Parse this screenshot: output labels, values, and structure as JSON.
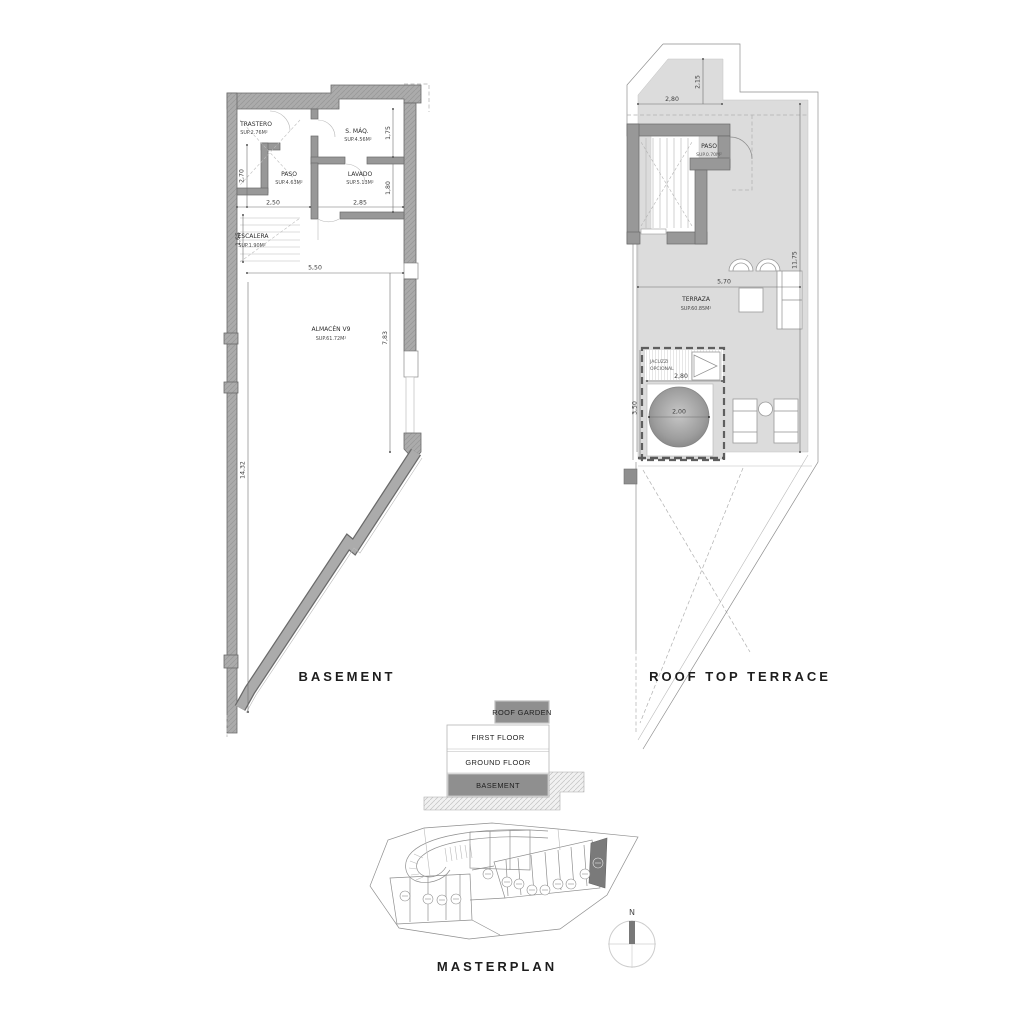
{
  "basement": {
    "title": "BASEMENT",
    "rooms": {
      "trastero": {
        "name": "TRASTERO",
        "area": "SUP.2.76M²"
      },
      "smaq": {
        "name": "S. MÁQ.",
        "area": "SUP.4.56M²"
      },
      "paso": {
        "name": "PASO",
        "area": "SUP.4.63M²"
      },
      "lavado": {
        "name": "LAVADO",
        "area": "SUP.5.13M²"
      },
      "escalera": {
        "name": "ESCALERA",
        "area": "SUP.1.90M²"
      },
      "almacen": {
        "name": "ALMACÉN V9",
        "area": "SUP.61.72M²"
      }
    },
    "dims": {
      "w270": "2,70",
      "w175": "1,75",
      "w180": "1,80",
      "w250": "2,50",
      "w285": "2,85",
      "w165": "1,65",
      "w550": "5,50",
      "w783": "7,83",
      "w1432": "14,32"
    }
  },
  "roof": {
    "title": "ROOF TOP TERRACE",
    "rooms": {
      "paso": {
        "name": "PASO",
        "area": "SUP.0.70M²"
      },
      "terraza": {
        "name": "TERRAZA",
        "area": "SUP.60.85M²"
      },
      "jacuzzi": {
        "line1": "JACUZZI",
        "line2": "OPCIONAL"
      }
    },
    "dims": {
      "w280top": "2,80",
      "w215": "2,15",
      "w1175": "11,75",
      "w570": "5,70",
      "w280j": "2,80",
      "w350": "3,50",
      "w200": "2,00"
    }
  },
  "stack": {
    "levels": [
      {
        "label": "ROOF GARDEN",
        "highlighted": true
      },
      {
        "label": "FIRST FLOOR",
        "highlighted": false
      },
      {
        "label": "GROUND FLOOR",
        "highlighted": false
      },
      {
        "label": "BASEMENT",
        "highlighted": true
      }
    ]
  },
  "masterplan": {
    "title": "MASTERPLAN",
    "compass_label": "N"
  },
  "colors": {
    "wall_gray": "#a9a9a9",
    "wall_dark": "#949494",
    "terrace_floor": "#dcdcdc",
    "highlight_box": "#8f8f8f",
    "dark_unit": "#7a7a7a",
    "line": "#8f8f8f"
  }
}
